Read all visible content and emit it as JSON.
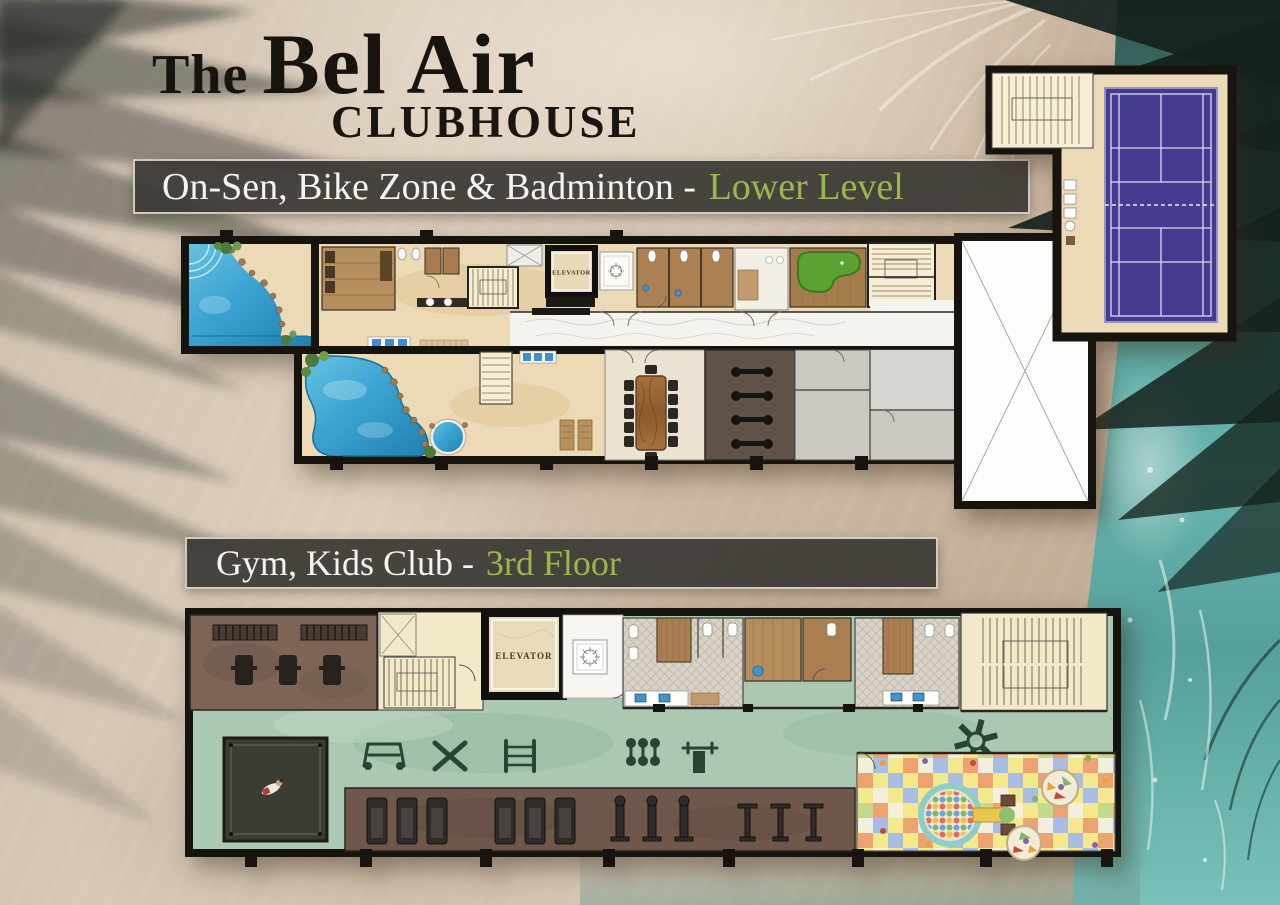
{
  "header": {
    "title_prefix": "The",
    "title_main": "Bel Air",
    "title_sub": "CLUBHOUSE"
  },
  "sections": [
    {
      "id": "lower-level",
      "banner_label": "On-Sen, Bike Zone & Badminton -",
      "banner_highlight": "Lower Level",
      "plan": {
        "elevator_label": "ELEVATOR",
        "features": [
          "onsen-pools",
          "locker-rooms",
          "sauna-rooms",
          "toilets",
          "elevator",
          "stairs",
          "putting-green",
          "meeting-room",
          "bike-zone",
          "badminton-court",
          "void-room"
        ]
      }
    },
    {
      "id": "third-floor",
      "banner_label": "Gym, Kids Club -",
      "banner_highlight": "3rd Floor",
      "plan": {
        "elevator_label": "ELEVATOR",
        "features": [
          "weights-room",
          "sparring-mat",
          "gym-floor",
          "cardio-row",
          "changing-rooms",
          "stairs",
          "elevator",
          "kids-club",
          "ball-pit",
          "kids-tables"
        ]
      }
    }
  ],
  "colors": {
    "banner_background": "#3b3935",
    "banner_text": "#f5f3ef",
    "banner_highlight": "#9bb74c",
    "title_text": "#17130e",
    "sand": "#d8c9b7",
    "ocean": "#5ea9a4",
    "pool_water": "#3fa6d3",
    "badminton_court": "#453c92",
    "putting_green": "#5ba233",
    "gym_floor": "#abc8b2",
    "kids_floor_yellow": "#f4e88c"
  }
}
